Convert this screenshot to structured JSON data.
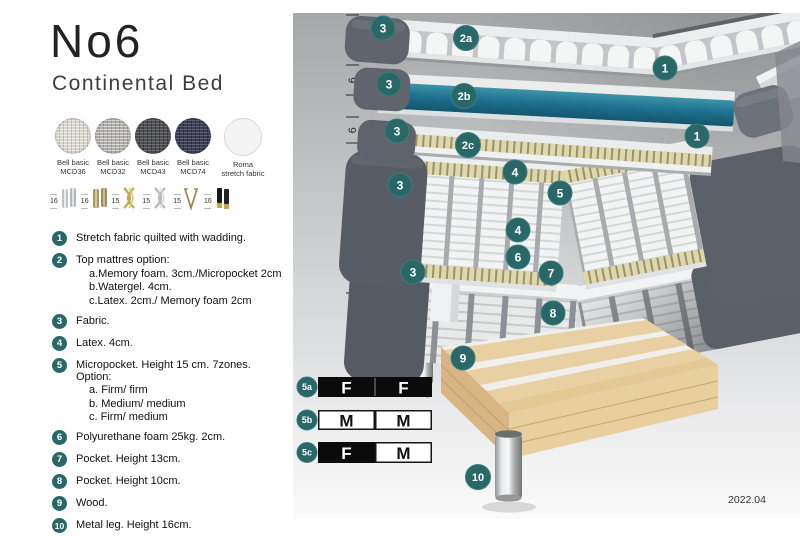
{
  "header": {
    "title": "No6",
    "subtitle": "Continental Bed"
  },
  "fabrics": [
    {
      "line1": "Bell basic",
      "line2": "MCD36",
      "color": "#d9d6ce",
      "shade": "light"
    },
    {
      "line1": "Bell basic",
      "line2": "MCD32",
      "color": "#b2b0ab",
      "shade": "light"
    },
    {
      "line1": "Bell basic",
      "line2": "MCD43",
      "color": "#4f5053",
      "shade": "dark"
    },
    {
      "line1": "Bell basic",
      "line2": "MCD74",
      "color": "#3c3f55",
      "shade": "dark"
    },
    {
      "line1": "Roma",
      "line2": "stretch fabric",
      "color": "#f4f4f4",
      "shade": "plain"
    }
  ],
  "legs": [
    {
      "height": "16",
      "type": "cylinder-silver"
    },
    {
      "height": "16",
      "type": "cylinder-brass"
    },
    {
      "height": "15",
      "type": "cross-gold"
    },
    {
      "height": "15",
      "type": "cross-silver"
    },
    {
      "height": "15",
      "type": "hairpin"
    },
    {
      "height": "16",
      "type": "black-gold"
    }
  ],
  "legend": [
    {
      "num": "1",
      "text": "Stretch fabric quilted with wadding."
    },
    {
      "num": "2",
      "text": "Top mattres option:",
      "subs": [
        "a.Memory foam. 3cm./Micropocket 2cm",
        "b.Watergel. 4cm.",
        "c.Latex. 2cm./ Memory foam 2cm"
      ]
    },
    {
      "num": "3",
      "text": "Fabric."
    },
    {
      "num": "4",
      "text": "Latex. 4cm."
    },
    {
      "num": "5",
      "text": "Micropocket. Height 15 cm. 7zones. Option:",
      "subs": [
        "a. Firm/ firm",
        "b. Medium/ medium",
        "c. Firm/ medium"
      ]
    },
    {
      "num": "6",
      "text": "Polyurethane foam 25kg. 2cm."
    },
    {
      "num": "7",
      "text": "Pocket. Height 13cm."
    },
    {
      "num": "8",
      "text": "Pocket. Height 10cm."
    },
    {
      "num": "9",
      "text": "Wood."
    },
    {
      "num": "10",
      "text": "Metal leg. Height 16cm."
    }
  ],
  "diagram": {
    "ruler": {
      "ticks_y": [
        2,
        30,
        52,
        82,
        104,
        130,
        194,
        280,
        337
      ],
      "labels": [
        {
          "text": "10",
          "y": 16
        },
        {
          "text": "6",
          "y": 67
        },
        {
          "text": "6",
          "y": 117
        },
        {
          "text": "23 cm",
          "y": 161
        },
        {
          "text": "27 cm",
          "y": 236
        },
        {
          "text": "16 cm",
          "y": 308
        }
      ]
    },
    "badges": [
      {
        "label": "3",
        "x": 90,
        "y": 15
      },
      {
        "label": "2a",
        "x": 173,
        "y": 25
      },
      {
        "label": "1",
        "x": 372,
        "y": 55
      },
      {
        "label": "3",
        "x": 96,
        "y": 71
      },
      {
        "label": "2b",
        "x": 171,
        "y": 83
      },
      {
        "label": "1",
        "x": 404,
        "y": 123
      },
      {
        "label": "3",
        "x": 104,
        "y": 118
      },
      {
        "label": "2c",
        "x": 175,
        "y": 132
      },
      {
        "label": "4",
        "x": 222,
        "y": 159
      },
      {
        "label": "5",
        "x": 267,
        "y": 180
      },
      {
        "label": "3",
        "x": 107,
        "y": 172
      },
      {
        "label": "4",
        "x": 225,
        "y": 217
      },
      {
        "label": "6",
        "x": 225,
        "y": 244
      },
      {
        "label": "7",
        "x": 258,
        "y": 260
      },
      {
        "label": "3",
        "x": 120,
        "y": 259
      },
      {
        "label": "8",
        "x": 260,
        "y": 300
      },
      {
        "label": "9",
        "x": 170,
        "y": 345
      },
      {
        "label": "10",
        "x": 185,
        "y": 464
      }
    ],
    "firmness": [
      {
        "id": "5a",
        "cells": [
          {
            "letter": "F",
            "style": "dark"
          },
          {
            "letter": "F",
            "style": "dark"
          }
        ]
      },
      {
        "id": "5b",
        "cells": [
          {
            "letter": "M",
            "style": "light"
          },
          {
            "letter": "M",
            "style": "light"
          }
        ]
      },
      {
        "id": "5c",
        "cells": [
          {
            "letter": "F",
            "style": "dark"
          },
          {
            "letter": "M",
            "style": "light"
          }
        ]
      }
    ],
    "version": "2022.04"
  },
  "colors": {
    "badge_teal": "#2a6868",
    "watergel_top": "#3d95a8",
    "watergel_bottom": "#14566e",
    "fabric_gray": "#585c64"
  }
}
